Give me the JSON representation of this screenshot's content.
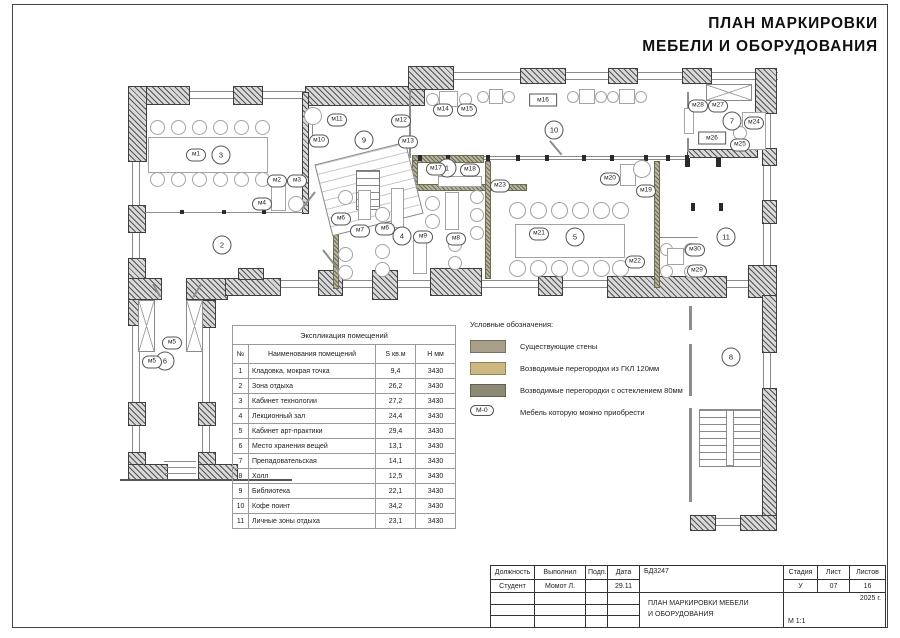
{
  "title": {
    "line1": "ПЛАН МАРКИРОВКИ",
    "line2": "МЕБЕЛИ И ОБОРУДОВАНИЯ"
  },
  "explication": {
    "title": "Экспликация помещений",
    "headers": [
      "№",
      "Наименования помещений",
      "S кв.м",
      "Н мм"
    ],
    "rows": [
      [
        "1",
        "Кладовка, мокрая точка",
        "9,4",
        "3430"
      ],
      [
        "2",
        "Зона отдыха",
        "26,2",
        "3430"
      ],
      [
        "3",
        "Кабинет технологии",
        "27,2",
        "3430"
      ],
      [
        "4",
        "Лекционный зал",
        "24,4",
        "3430"
      ],
      [
        "5",
        "Кабинет арт-практики",
        "29,4",
        "3430"
      ],
      [
        "6",
        "Место хранения вещей",
        "13,1",
        "3430"
      ],
      [
        "7",
        "Препадовательская",
        "14,1",
        "3430"
      ],
      [
        "8",
        "Холл",
        "12,5",
        "3430"
      ],
      [
        "9",
        "Библиотека",
        "22,1",
        "3430"
      ],
      [
        "10",
        "Кофе поинт",
        "34,2",
        "3430"
      ],
      [
        "11",
        "Личные зоны отдыха",
        "23,1",
        "3430"
      ]
    ]
  },
  "legend": {
    "title": "Условные обозначения:",
    "items": [
      {
        "swatch": "#a9a08c",
        "label": "Существующие стены"
      },
      {
        "swatch": "#cdb97f",
        "label": "Возводимые перегородки из ГКЛ 120мм"
      },
      {
        "swatch": "#8c8a74",
        "label": "Возводимые перегородки с остеклением 80мм"
      }
    ],
    "furniture_marker": {
      "badge": "М-0",
      "label": "Мебель которую можно приобрести"
    }
  },
  "titleblock": {
    "col_headers": [
      "Должность",
      "Выполнил",
      "Подп.",
      "Дата"
    ],
    "row": [
      "Студент",
      "Момот Л.",
      "",
      "29.11"
    ],
    "doc_code": "БД3247",
    "drawing_title_line1": "ПЛАН МАРКИРОВКИ МЕБЕЛИ",
    "drawing_title_line2": "И ОБОРУДОВАНИЯ",
    "stage_header": "Стадия",
    "sheet_header": "Лист",
    "sheets_header": "Листов",
    "stage": "У",
    "sheet": "07",
    "sheets": "16",
    "year": "2025 г.",
    "scale": "М 1:1"
  },
  "plan": {
    "room_markers": [
      {
        "n": "1",
        "x": 447,
        "y": 168
      },
      {
        "n": "2",
        "x": 222,
        "y": 245
      },
      {
        "n": "3",
        "x": 221,
        "y": 155
      },
      {
        "n": "4",
        "x": 402,
        "y": 236
      },
      {
        "n": "5",
        "x": 575,
        "y": 237
      },
      {
        "n": "6",
        "x": 165,
        "y": 361
      },
      {
        "n": "7",
        "x": 732,
        "y": 121
      },
      {
        "n": "8",
        "x": 731,
        "y": 357
      },
      {
        "n": "9",
        "x": 364,
        "y": 140
      },
      {
        "n": "10",
        "x": 554,
        "y": 130
      },
      {
        "n": "11",
        "x": 726,
        "y": 237
      }
    ],
    "furniture_markers": [
      {
        "label": "м1",
        "x": 196,
        "y": 155
      },
      {
        "label": "м2",
        "x": 277,
        "y": 181
      },
      {
        "label": "м3",
        "x": 297,
        "y": 181
      },
      {
        "label": "м4",
        "x": 262,
        "y": 204
      },
      {
        "label": "м5",
        "x": 172,
        "y": 343
      },
      {
        "label": "м5",
        "x": 152,
        "y": 362
      },
      {
        "label": "м6",
        "x": 341,
        "y": 219
      },
      {
        "label": "м7",
        "x": 360,
        "y": 231
      },
      {
        "label": "м6",
        "x": 385,
        "y": 229
      },
      {
        "label": "м8",
        "x": 456,
        "y": 239
      },
      {
        "label": "м9",
        "x": 423,
        "y": 237
      },
      {
        "label": "м10",
        "x": 319,
        "y": 141
      },
      {
        "label": "м11",
        "x": 337,
        "y": 120
      },
      {
        "label": "м12",
        "x": 401,
        "y": 121
      },
      {
        "label": "м13",
        "x": 408,
        "y": 142
      },
      {
        "label": "м14",
        "x": 443,
        "y": 110
      },
      {
        "label": "м15",
        "x": 467,
        "y": 110
      },
      {
        "label": "м17",
        "x": 436,
        "y": 169
      },
      {
        "label": "м18",
        "x": 470,
        "y": 170
      },
      {
        "label": "м19",
        "x": 646,
        "y": 191
      },
      {
        "label": "м20",
        "x": 610,
        "y": 179
      },
      {
        "label": "м21",
        "x": 539,
        "y": 234
      },
      {
        "label": "м22",
        "x": 635,
        "y": 262
      },
      {
        "label": "м23",
        "x": 500,
        "y": 186
      },
      {
        "label": "м24",
        "x": 754,
        "y": 123
      },
      {
        "label": "м25",
        "x": 740,
        "y": 145
      },
      {
        "label": "м27",
        "x": 718,
        "y": 106
      },
      {
        "label": "м28",
        "x": 698,
        "y": 106
      },
      {
        "label": "м29",
        "x": 697,
        "y": 271
      },
      {
        "label": "м30",
        "x": 695,
        "y": 250
      }
    ],
    "boxed_markers": [
      {
        "label": "м16",
        "x": 543,
        "y": 100
      },
      {
        "label": "м26",
        "x": 712,
        "y": 138
      }
    ]
  }
}
